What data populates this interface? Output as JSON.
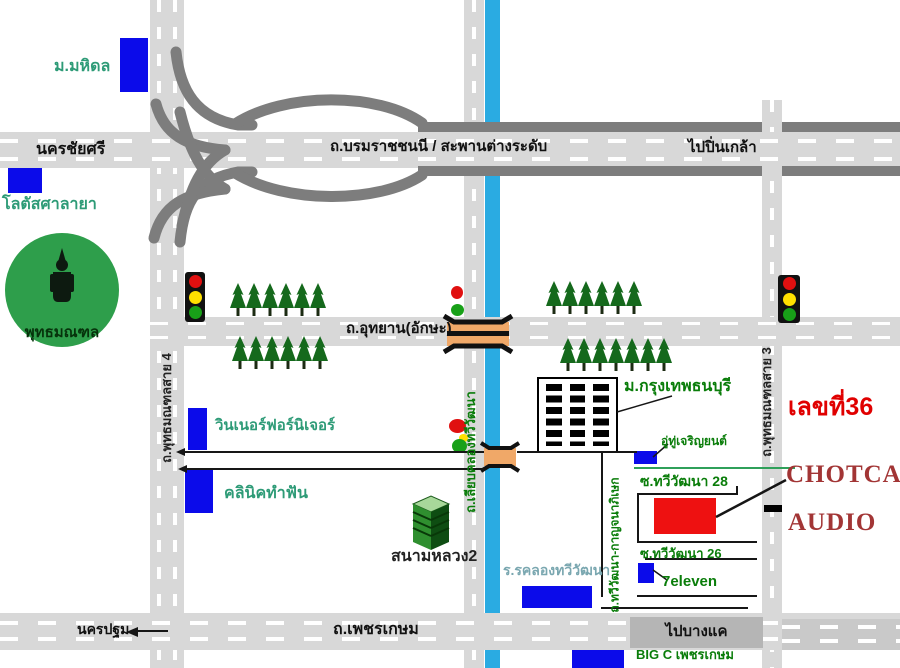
{
  "labels": {
    "mahidol": "ม.มหิดล",
    "nakhon_chai_si": "นครชัยศรี",
    "lotus_salaya": "โลตัสศาลายา",
    "borom_highway": "ถ.บรมราชชนนี   /   สะพานต่างระดับ",
    "to_pinklao": "ไปปิ่นเกล้า",
    "phutthamonthon": "พุทธมณฑล",
    "sai4": "ถ.พุทธมณฑลสาย 4",
    "sai3": "ถ.พุทธมณฑลสาย 3",
    "utthayan": "ถ.อุทยาน(อักษะ)",
    "winner": "วินเนอร์ฟอร์นิเจอร์",
    "clinic": "คลินิคทำฟัน",
    "liap_khlong": "ถ.เลียบคลองทวีวัฒนา",
    "sanam_luang2": "สนามหลวง2",
    "bkk_thonburi_u": "ม.กรุงเทพธนบุรี",
    "garage": "อู่ทู่เจริญยนต์",
    "house_no": "เลขที่36",
    "soi28": "ซ.ทวีวัฒนา 28",
    "brand_line1": "CHOTCAR",
    "brand_line2": "AUDIO",
    "soi26": "ซ.ทวีวัฒนา 26",
    "seven_eleven": "7eleven",
    "thawi_kanchana": "ถ.ทวีวัฒนา-กาญจนาภิเษก",
    "school": "ร.รคลองทวีวัฒนา",
    "nakhon_pathom": "นครปฐม",
    "phetkasem": "ถ.เพชรเกษม",
    "to_bang_khae": "ไปบางแค",
    "big_c": "BIG C เพชรเกษม"
  },
  "colors": {
    "canal": "#2aabe2",
    "road": "#d8d8d8",
    "road_dark": "#7d7d7d",
    "marker_blue": "#0b0bea",
    "destination_red": "#ee1111",
    "tree_green": "#15691c",
    "park_green": "#2e9e4b",
    "bridge_orange": "#f0a868",
    "label_teal": "#2e9b77",
    "label_green": "#0a7d0a",
    "label_red": "#e00000",
    "brand_red": "#a23535"
  },
  "icons": {
    "traffic_light": "red-yellow-green-signal",
    "tree": "pine-tree",
    "buddha_statue": "black-statue-silhouette",
    "bridge": "orange-canal-bridge",
    "left_arrow": "direction-arrow-left"
  }
}
